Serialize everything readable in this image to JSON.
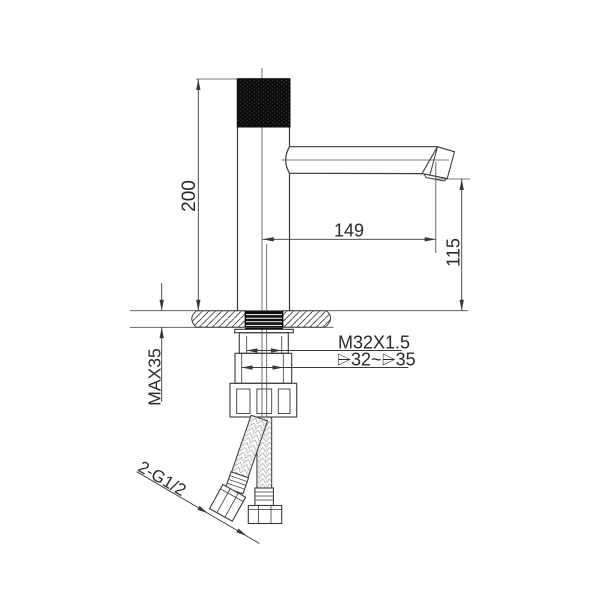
{
  "drawing": {
    "type": "technical-installation-drawing",
    "subject": "single-lever basin faucet with mounting hardware and flexible supply hoses",
    "labels": {
      "overall_height": "200",
      "spout_reach": "149",
      "spout_outlet_height": "115",
      "shank_thread": "M32X1.5",
      "mounting_hole": "⌲32~⌲35",
      "max_deck_thickness": "MAX35",
      "supply_connections": "2-G1/2"
    },
    "colors": {
      "line": "#3a3a3a",
      "black_fill": "#0d0d0d",
      "background": "#ffffff"
    }
  }
}
